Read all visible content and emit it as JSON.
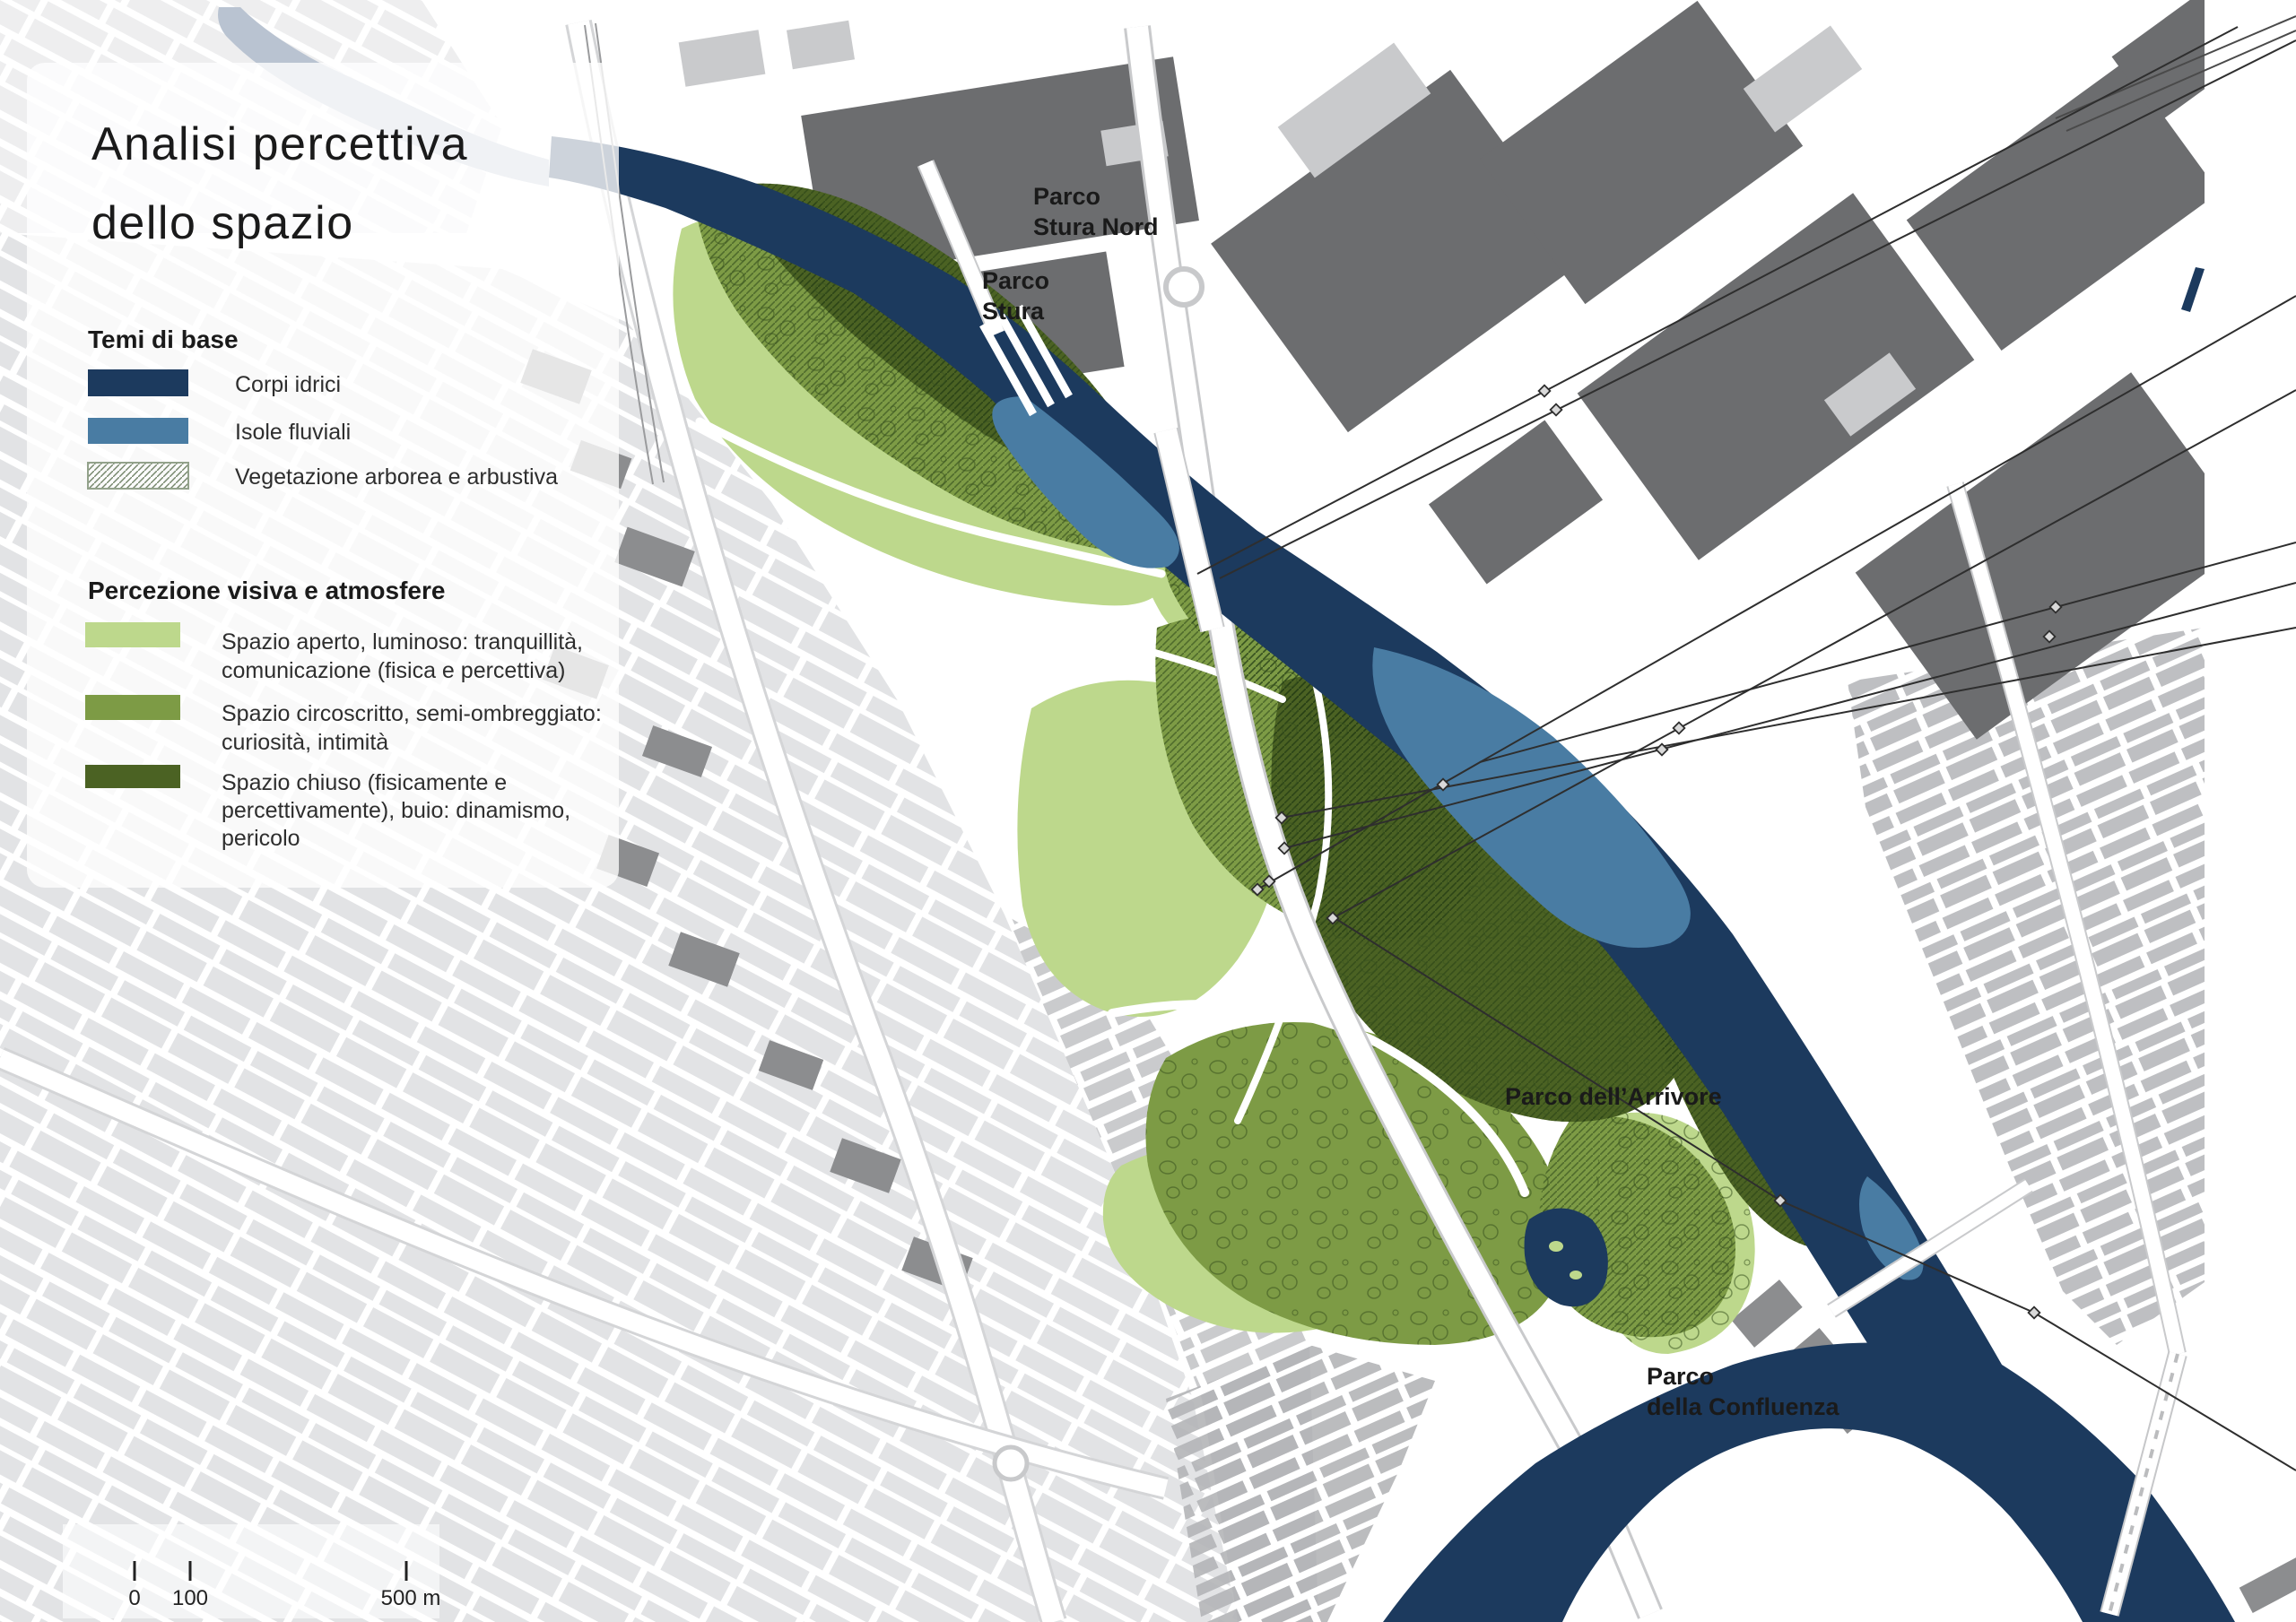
{
  "title": {
    "lines": [
      "Analisi percettiva",
      "dello spazio"
    ]
  },
  "legend_base": {
    "heading": "Temi di base",
    "items": [
      {
        "label": "Corpi idrici",
        "color": "#1c3a5e",
        "swatch": "solid"
      },
      {
        "label": "Isole fluviali",
        "color": "#497ca3",
        "swatch": "solid"
      },
      {
        "label": "Vegetazione arborea e arbustiva",
        "swatch": "hatch"
      }
    ]
  },
  "legend_perception": {
    "heading": "Percezione visiva e atmosfere",
    "items": [
      {
        "lines": [
          "Spazio aperto, luminoso: tranquillità,",
          "comunicazione (fisica e percettiva)"
        ],
        "color": "#bdd88c"
      },
      {
        "lines": [
          "Spazio circoscritto, semi-ombreggiato:",
          "curiosità, intimità"
        ],
        "color": "#7d9b45"
      },
      {
        "lines": [
          "Spazio chiuso (fisicamente e",
          "percettivamente), buio: dinamismo,",
          "pericolo"
        ],
        "color": "#4b6223"
      }
    ]
  },
  "map_labels": {
    "stura_nord": {
      "lines": [
        "Parco",
        "Stura Nord"
      ]
    },
    "stura": {
      "lines": [
        "Parco",
        "Stura"
      ]
    },
    "arrivore": {
      "label": "Parco dell’Arrivore"
    },
    "confluenza": {
      "lines": [
        "Parco",
        "della Confluenza"
      ]
    }
  },
  "scale_bar": {
    "tick0": "0",
    "tick100": "100",
    "tick500": "500 m"
  },
  "colors": {
    "water": "#1c3a5e",
    "island": "#497ca3",
    "upstream_river": "#b9c3d1",
    "open_space": "#bdd88c",
    "semi_enclosed": "#7d9b45",
    "closed_space": "#4b6223"
  }
}
